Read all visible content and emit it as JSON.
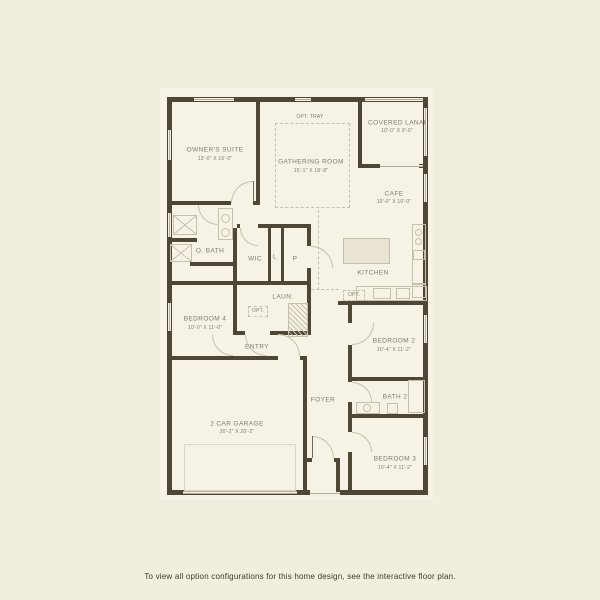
{
  "caption": "To view all option configurations for this home design, see the interactive floor plan.",
  "colors": {
    "bg": "#f1eddf",
    "paper": "#f6f3e6",
    "wall": "#4e4736",
    "line": "#c6c0ab",
    "label": "#81796a",
    "caption": "#3e3a2f"
  },
  "labels": {
    "owners_suite": {
      "name": "OWNER'S SUITE",
      "dims": "13'-0\" x 15'-0\""
    },
    "gathering_room": {
      "name": "GATHERING ROOM",
      "dims": "15'-1\" x 18'-8\""
    },
    "opt_tray": {
      "name": "OPT. TRAY"
    },
    "covered_lanai": {
      "name": "COVERED LANAI",
      "dims": "10'-0\" x 9'-0\""
    },
    "cafe": {
      "name": "CAFE",
      "dims": "10'-0\" x 10'-0\""
    },
    "kitchen": {
      "name": "KITCHEN"
    },
    "o_bath": {
      "name": "O. BATH"
    },
    "wic": {
      "name": "WIC"
    },
    "linen": {
      "name": "L"
    },
    "pantry": {
      "name": "P"
    },
    "laundry": {
      "name": "LAUN."
    },
    "opt_laundry": {
      "name": "OPT."
    },
    "opt_kitchen": {
      "name": "OPT."
    },
    "bedroom4": {
      "name": "BEDROOM 4",
      "dims": "10'-0\" x 11'-0\""
    },
    "entry": {
      "name": "ENTRY"
    },
    "bedroom2": {
      "name": "BEDROOM 2",
      "dims": "10'-4\" x 11'-2\""
    },
    "foyer": {
      "name": "FOYER"
    },
    "bath2": {
      "name": "BATH 2"
    },
    "garage": {
      "name": "2 CAR GARAGE",
      "dims": "20'-2\" x 20'-2\""
    },
    "bedroom3": {
      "name": "BEDROOM 3",
      "dims": "10'-4\" x 11'-2\""
    }
  }
}
